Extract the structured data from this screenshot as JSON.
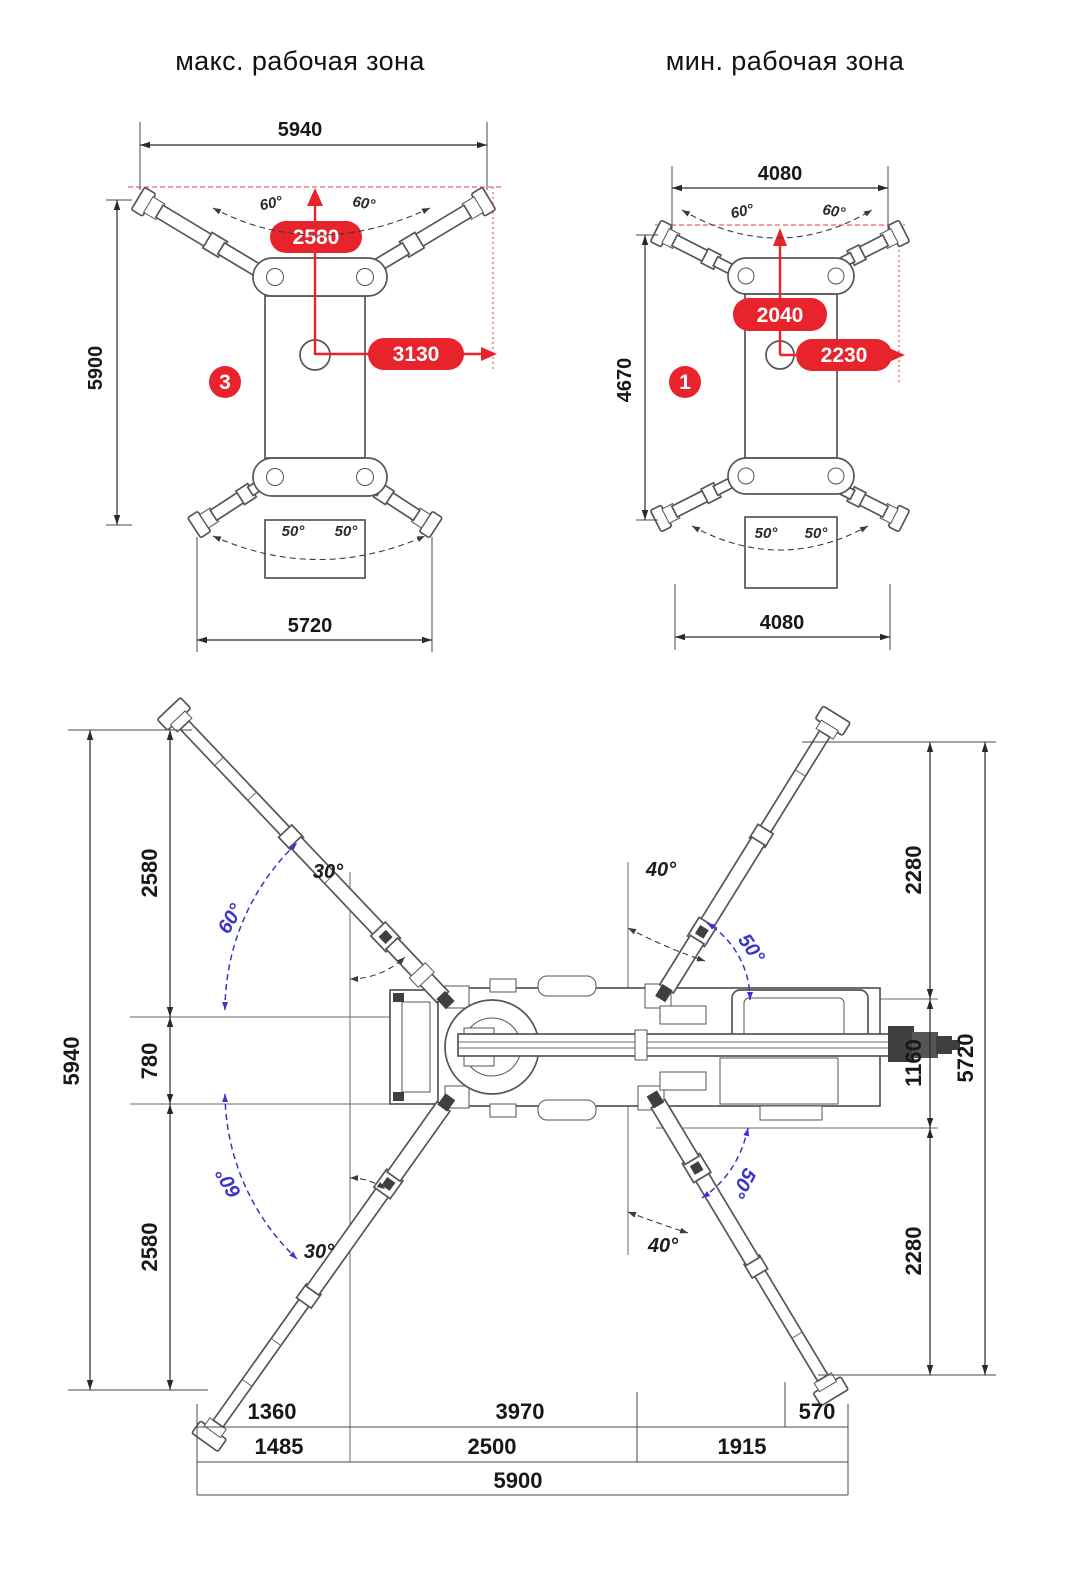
{
  "titles": {
    "max_zone": "макс. рабочая зона",
    "min_zone": "мин. рабочая зона"
  },
  "colors": {
    "accent_red": "#e8232b",
    "angle_blue": "#3b35c8",
    "line_dark": "#2a2a2a",
    "machine_gray": "#565656",
    "red_guide": "#f37f7f"
  },
  "max_zone": {
    "index": "3",
    "top_width": "5940",
    "left_height": "5900",
    "bottom_width": "5720",
    "vertical_reach": "2580",
    "horizontal_reach": "3130",
    "front_angle_left": "60°",
    "front_angle_right": "60°",
    "rear_angle_left": "50°",
    "rear_angle_right": "50°"
  },
  "min_zone": {
    "index": "1",
    "top_width": "4080",
    "left_height": "4670",
    "bottom_width": "4080",
    "vertical_reach": "2040",
    "horizontal_reach": "2230",
    "front_angle_left": "60°",
    "front_angle_right": "60°",
    "rear_angle_left": "50°",
    "rear_angle_right": "50°"
  },
  "plan_view": {
    "left": {
      "total": "5940",
      "top": "2580",
      "middle": "780",
      "bottom": "2580"
    },
    "right": {
      "total": "5720",
      "top": "2280",
      "middle": "1160",
      "bottom": "2280"
    },
    "angles": {
      "top_left_outer": "30°",
      "top_left_inner": "60°",
      "top_right_outer": "40°",
      "top_right_inner": "50°",
      "bottom_left_inner": "60°",
      "bottom_left_outer": "30°",
      "bottom_right_inner": "50°",
      "bottom_right_outer": "40°"
    },
    "bottom_rows": {
      "row1": [
        "1360",
        "3970",
        "570"
      ],
      "row2": [
        "1485",
        "2500",
        "1915"
      ],
      "row3": [
        "5900"
      ]
    }
  }
}
